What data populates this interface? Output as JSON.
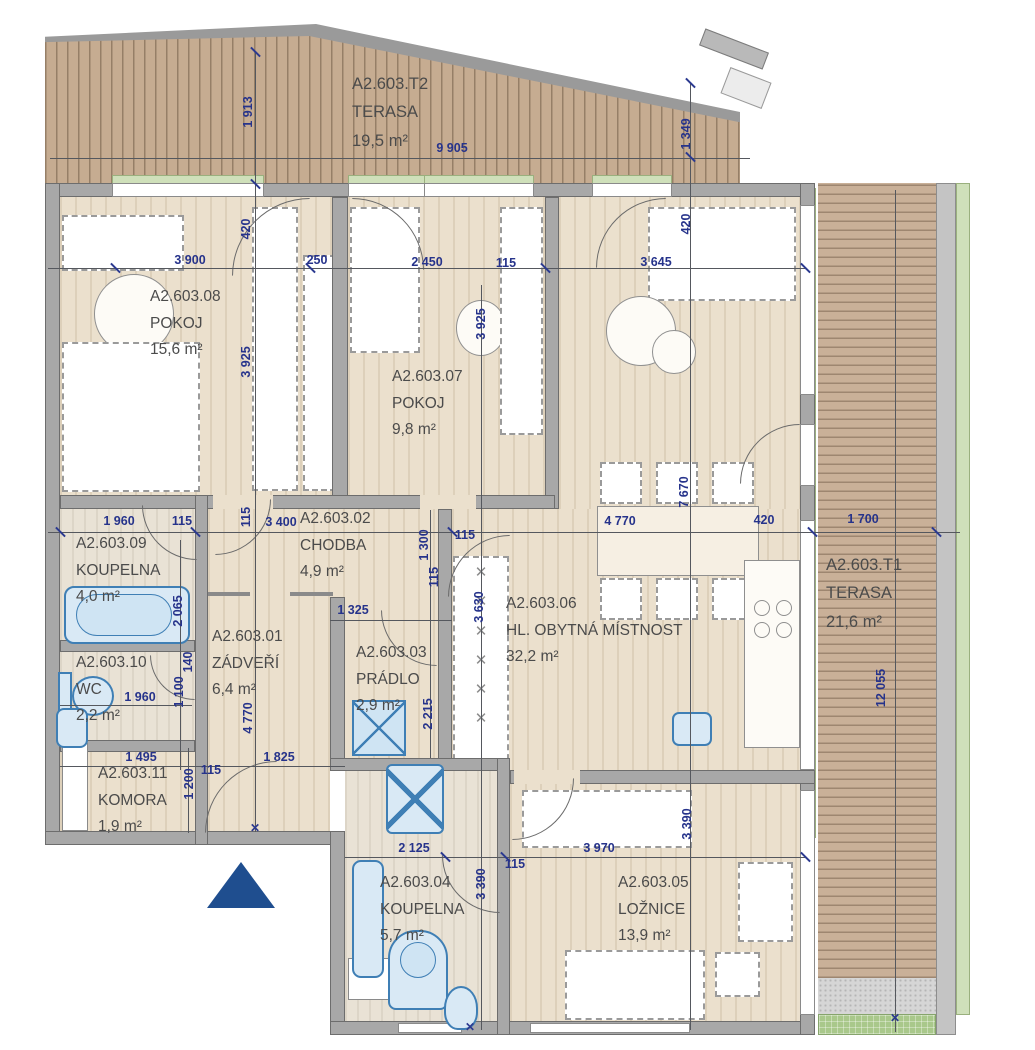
{
  "rooms": {
    "t2": {
      "id": "A2.603.T2",
      "name": "TERASA",
      "area": "19,5 m²"
    },
    "t1": {
      "id": "A2.603.T1",
      "name": "TERASA",
      "area": "21,6 m²"
    },
    "r01": {
      "id": "A2.603.01",
      "name": "ZÁDVEŘÍ",
      "area": "6,4 m²"
    },
    "r02": {
      "id": "A2.603.02",
      "name": "CHODBA",
      "area": "4,9 m²"
    },
    "r03": {
      "id": "A2.603.03",
      "name": "PRÁDLO",
      "area": "2,9 m²"
    },
    "r04": {
      "id": "A2.603.04",
      "name": "KOUPELNA",
      "area": "5,7 m²"
    },
    "r05": {
      "id": "A2.603.05",
      "name": "LOŽNICE",
      "area": "13,9 m²"
    },
    "r06": {
      "id": "A2.603.06",
      "name": "HL. OBYTNÁ MÍSTNOST",
      "area": "32,2 m²"
    },
    "r07": {
      "id": "A2.603.07",
      "name": "POKOJ",
      "area": "9,8 m²"
    },
    "r08": {
      "id": "A2.603.08",
      "name": "POKOJ",
      "area": "15,6 m²"
    },
    "r09": {
      "id": "A2.603.09",
      "name": "KOUPELNA",
      "area": "4,0 m²"
    },
    "r10": {
      "id": "A2.603.10",
      "name": "WC",
      "area": "2,2 m²"
    },
    "r11": {
      "id": "A2.603.11",
      "name": "KOMORA",
      "area": "1,9 m²"
    }
  },
  "dims": {
    "d9905": "9 905",
    "d1913": "1 913",
    "d1349": "1 349",
    "d420a": "420",
    "d420b": "420",
    "d3900": "3 900",
    "d250": "250",
    "d2450": "2 450",
    "d115a": "115",
    "d3645": "3 645",
    "d3925a": "3 925",
    "d3925b": "3 925",
    "d1960a": "1 960",
    "d115b": "115",
    "d115c": "115",
    "d3400": "3 400",
    "d4770a": "4 770",
    "d420c": "420",
    "d1700": "1 700",
    "d7670": "7 670",
    "d2065": "2 065",
    "d1300": "1 300",
    "d115d": "115",
    "d115e": "115",
    "d1325": "1 325",
    "d3630": "3 630",
    "d2215": "2 215",
    "d140": "140",
    "d1100": "1 100",
    "d1960b": "1 960",
    "d4770b": "4 770",
    "d1495": "1 495",
    "d115f": "115",
    "d1200": "1 200",
    "d1825": "1 825",
    "d2125": "2 125",
    "d115g": "115",
    "d3970": "3 970",
    "d3390a": "3 390",
    "d3390b": "3 390",
    "d12055": "12 055"
  },
  "colors": {
    "wood": "#c6ac91",
    "floor": "#ebe0cd",
    "wall": "#a8a8a8",
    "fixture": "#3f7fb5",
    "dim_text": "#26338b",
    "sill": "#cfe0ba",
    "grass": "#a9c88b",
    "entrance": "#1f4e8f"
  }
}
